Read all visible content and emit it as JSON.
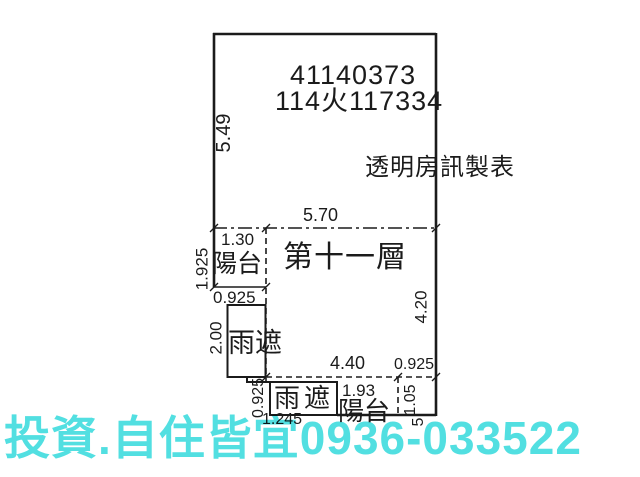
{
  "title_block": {
    "case_no": "41140373",
    "ref_no": "114火117334",
    "maker": "透明房訊製表"
  },
  "floor": {
    "label": "第十一層"
  },
  "areas": {
    "top_balcony": "陽台",
    "canopy_upper": "雨遮",
    "canopy_lower": "雨遮",
    "bottom_balcony": "陽台"
  },
  "dims": {
    "left_height": "5.49",
    "top_width": "5.70",
    "top_balcony_width": "1.30",
    "top_balcony_height": "1.925",
    "top_balcony_bottom": "0.925",
    "canopy_upper_height": "2.00",
    "main_right_height": "4.20",
    "lower_span": "4.40",
    "lower_right": "0.925",
    "canopy_lower_height": "0.925",
    "bottom_balcony_width": "1.93",
    "bottom_balcony_height": "1.05",
    "canopy_lower_width": "1.245",
    "cut_digit": "5"
  },
  "watermark": {
    "text": "投資.自住皆宜0936-033522",
    "color": "#52dfe1"
  },
  "style": {
    "line_color": "#1b1b1b",
    "bg": "#ffffff"
  }
}
